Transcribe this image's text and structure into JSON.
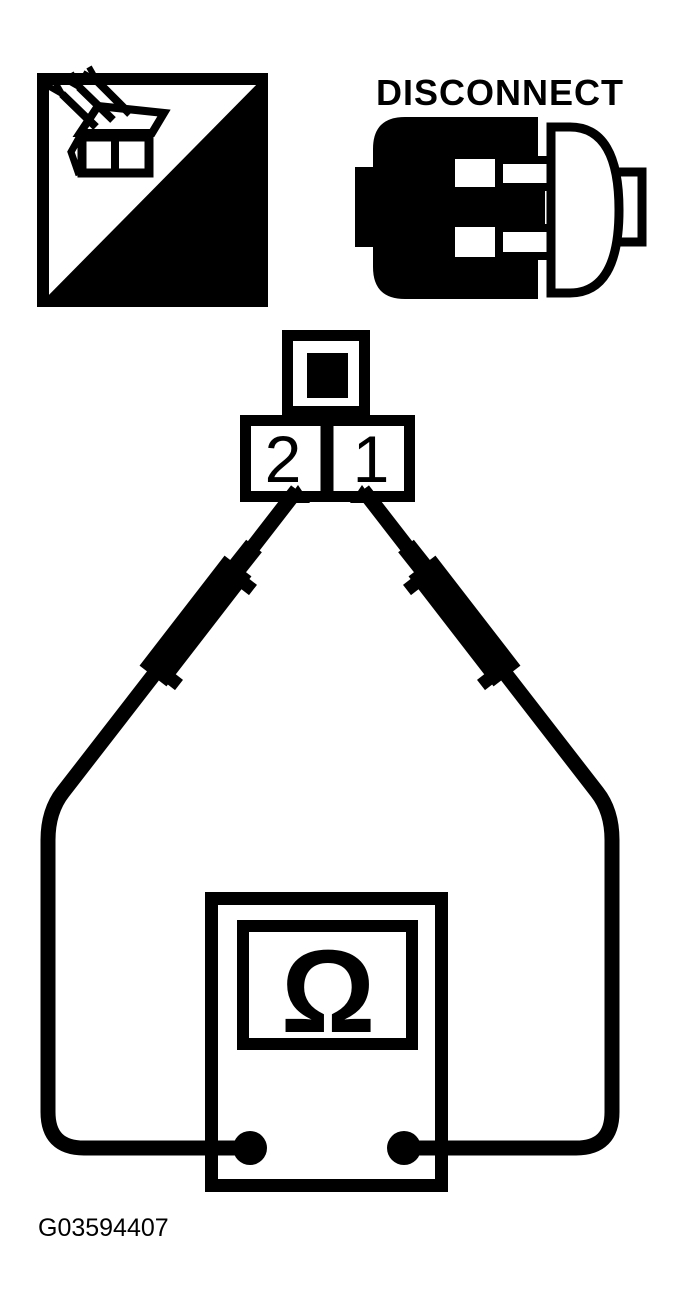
{
  "page": {
    "kind": "service-manual-test-diagram",
    "paper_color": "#ffffff",
    "ink_color": "#000000"
  },
  "header_icons": {
    "ts_tool": {
      "label": "T.S."
    },
    "disconnect": {
      "label": "DISCONNECT"
    }
  },
  "connector": {
    "pin_left": "2",
    "pin_right": "1"
  },
  "meter": {
    "display_symbol": "Ω"
  },
  "figure_id": "G03594407"
}
